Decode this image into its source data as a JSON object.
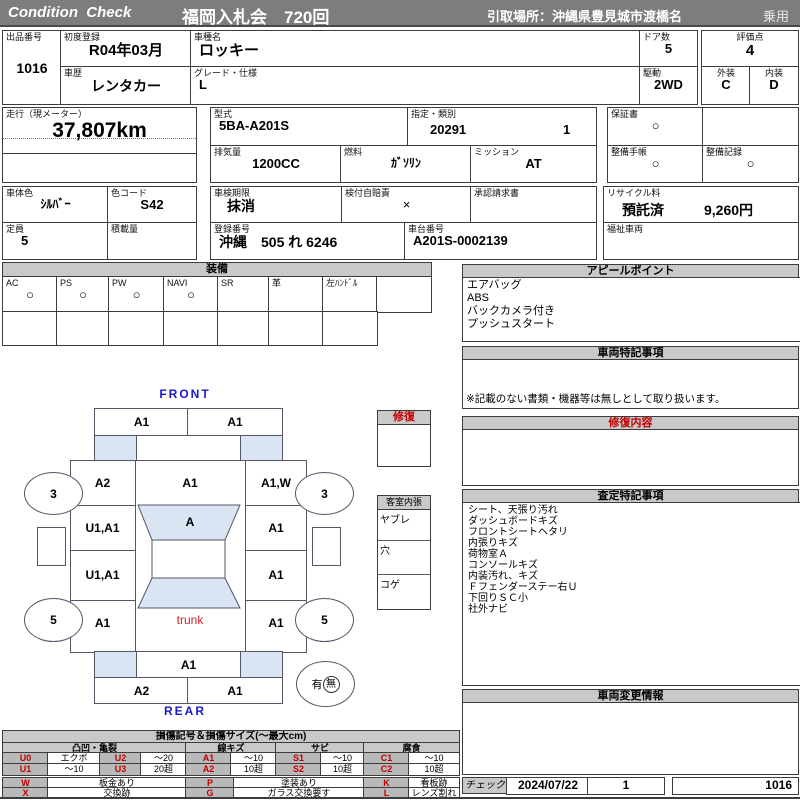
{
  "header": {
    "brand": "Condition  Check",
    "auction": "福岡入札会　720回",
    "pickup": "引取場所：沖縄県豊見城市渡橋名",
    "category": "乗用"
  },
  "info": {
    "lot_label": "出品番号",
    "lot": "1016",
    "first_reg_label": "初度登録",
    "first_reg": "R04年03月",
    "history_label": "車歴",
    "history": "レンタカー",
    "model_name_label": "車種名",
    "model_name": "ロッキー",
    "grade_label": "グレード・仕様",
    "grade": "L",
    "doors_label": "ドア数",
    "doors": "5",
    "drive_label": "駆動",
    "drive": "2WD",
    "score_label": "評価点",
    "score": "4",
    "exterior_label": "外装",
    "exterior": "C",
    "interior_label": "内装",
    "interior": "D",
    "mileage_label": "走行（現メーター）",
    "mileage": "37,807km",
    "model_code_label": "型式",
    "model_code": "5BA-A201S",
    "class_label": "指定・類別",
    "class1": "20291",
    "class2": "1",
    "warranty_label": "保証書",
    "warranty": "○",
    "displacement_label": "排気量",
    "displacement": "1200CC",
    "fuel_label": "燃料",
    "fuel": "ｶﾞｿﾘﾝ",
    "mission_label": "ミッション",
    "mission": "AT",
    "maint_book_label": "整備手帳",
    "maint_book": "○",
    "maint_rec_label": "整備記録",
    "maint_rec": "○",
    "color_label": "車体色",
    "color": "ｼﾙﾊﾞｰ",
    "color_code_label": "色コード",
    "color_code": "S42",
    "inspection_label": "車検期限",
    "inspection": "抹消",
    "insurance_label": "検付自賠責",
    "insurance": "×",
    "approval_label": "承認請求書",
    "recycle_label": "リサイクル料",
    "recycle_status": "預託済",
    "recycle_fee": "9,260円",
    "capacity_label": "定員",
    "capacity": "5",
    "load_label": "積載量",
    "reg_no_label": "登録番号",
    "reg_no": "沖縄　505 れ 6246",
    "chassis_label": "車台番号",
    "chassis": "A201S-0002139",
    "welfare_label": "福祉車両"
  },
  "equip": {
    "title": "装備",
    "items": [
      {
        "label": "AC",
        "mark": "○"
      },
      {
        "label": "PS",
        "mark": "○"
      },
      {
        "label": "PW",
        "mark": "○"
      },
      {
        "label": "NAVI",
        "mark": "○"
      },
      {
        "label": "SR",
        "mark": ""
      },
      {
        "label": "革",
        "mark": ""
      },
      {
        "label": "左ﾊﾝﾄﾞﾙ",
        "mark": ""
      },
      {
        "label": "",
        "mark": ""
      }
    ]
  },
  "appeal": {
    "title": "アピールポイント",
    "items": [
      "エアバッグ",
      "ABS",
      "バックカメラ付き",
      "プッシュスタート"
    ]
  },
  "notes": {
    "title": "車両特記事項",
    "note": "※記載のない書類・機器等は無しとして取り扱います。"
  },
  "repair": {
    "title": "修復内容"
  },
  "assess": {
    "title": "査定特記事項",
    "items": [
      "シート、天張り汚れ",
      "ダッシュボードキズ",
      "フロントシートヘタリ",
      "内張りキズ",
      "荷物室Ａ",
      "コンソールキズ",
      "内装汚れ、キズ",
      "Ｆフェンダーステー右Ｕ",
      "下回りＳＣ小",
      "社外ナビ"
    ]
  },
  "changes": {
    "title": "車両変更情報"
  },
  "check": {
    "label": "チェック",
    "date": "2024/07/22",
    "count": "1",
    "lot": "1016"
  },
  "diagram": {
    "front_label": "FRONT",
    "rear_label": "REAR",
    "front_bumper_left": "A1",
    "front_bumper_right": "A1",
    "hood_left": "A2",
    "hood_center": "A1",
    "hood_right": "A1,W",
    "windshield": "A",
    "front_door_left": "U1,A1",
    "front_door_right": "A1",
    "rear_door_left": "U1,A1",
    "rear_door_right": "A1",
    "rear_fender_left": "A1",
    "rear_fender_right": "A1",
    "trunk": "trunk",
    "rear_panel": "A1",
    "rear_bumper_left": "A2",
    "rear_bumper_right": "A1",
    "front_wheel_left": "3",
    "front_wheel_right": "3",
    "rear_wheel_left": "5",
    "rear_wheel_right": "5",
    "spare_present": "有",
    "spare_absent": "無",
    "repair_box_label": "修復",
    "cabin_label": "客室内張",
    "cabin_items": [
      "ヤブレ",
      "穴",
      "コゲ"
    ]
  },
  "legend": {
    "title": "損傷記号＆損傷サイズ(～最大cm)",
    "groups": [
      "凸凹・亀裂",
      "線キズ",
      "サビ",
      "腐食"
    ],
    "row1": [
      [
        "U0",
        "エクボ"
      ],
      [
        "U2",
        "～20"
      ],
      [
        "A1",
        "～10"
      ],
      [
        "S1",
        "～10"
      ],
      [
        "C1",
        "～10"
      ]
    ],
    "row2": [
      [
        "U1",
        "～10"
      ],
      [
        "U3",
        "20超"
      ],
      [
        "A2",
        "10超"
      ],
      [
        "S2",
        "10超"
      ],
      [
        "C2",
        "10超"
      ]
    ],
    "marks1": [
      [
        "W",
        "板金あり"
      ],
      [
        "P",
        "塗装あり"
      ],
      [
        "K",
        "看板跡"
      ]
    ],
    "marks2": [
      [
        "X",
        "交換跡"
      ],
      [
        "G",
        "ガラス交換要す"
      ],
      [
        "L",
        "レンズ割れ"
      ]
    ]
  },
  "colors": {
    "accent_red": "#c00000",
    "accent_blue": "#1a1acc",
    "glass_blue": "#d9e5f3",
    "bar_gray": "#7d7d7d"
  }
}
